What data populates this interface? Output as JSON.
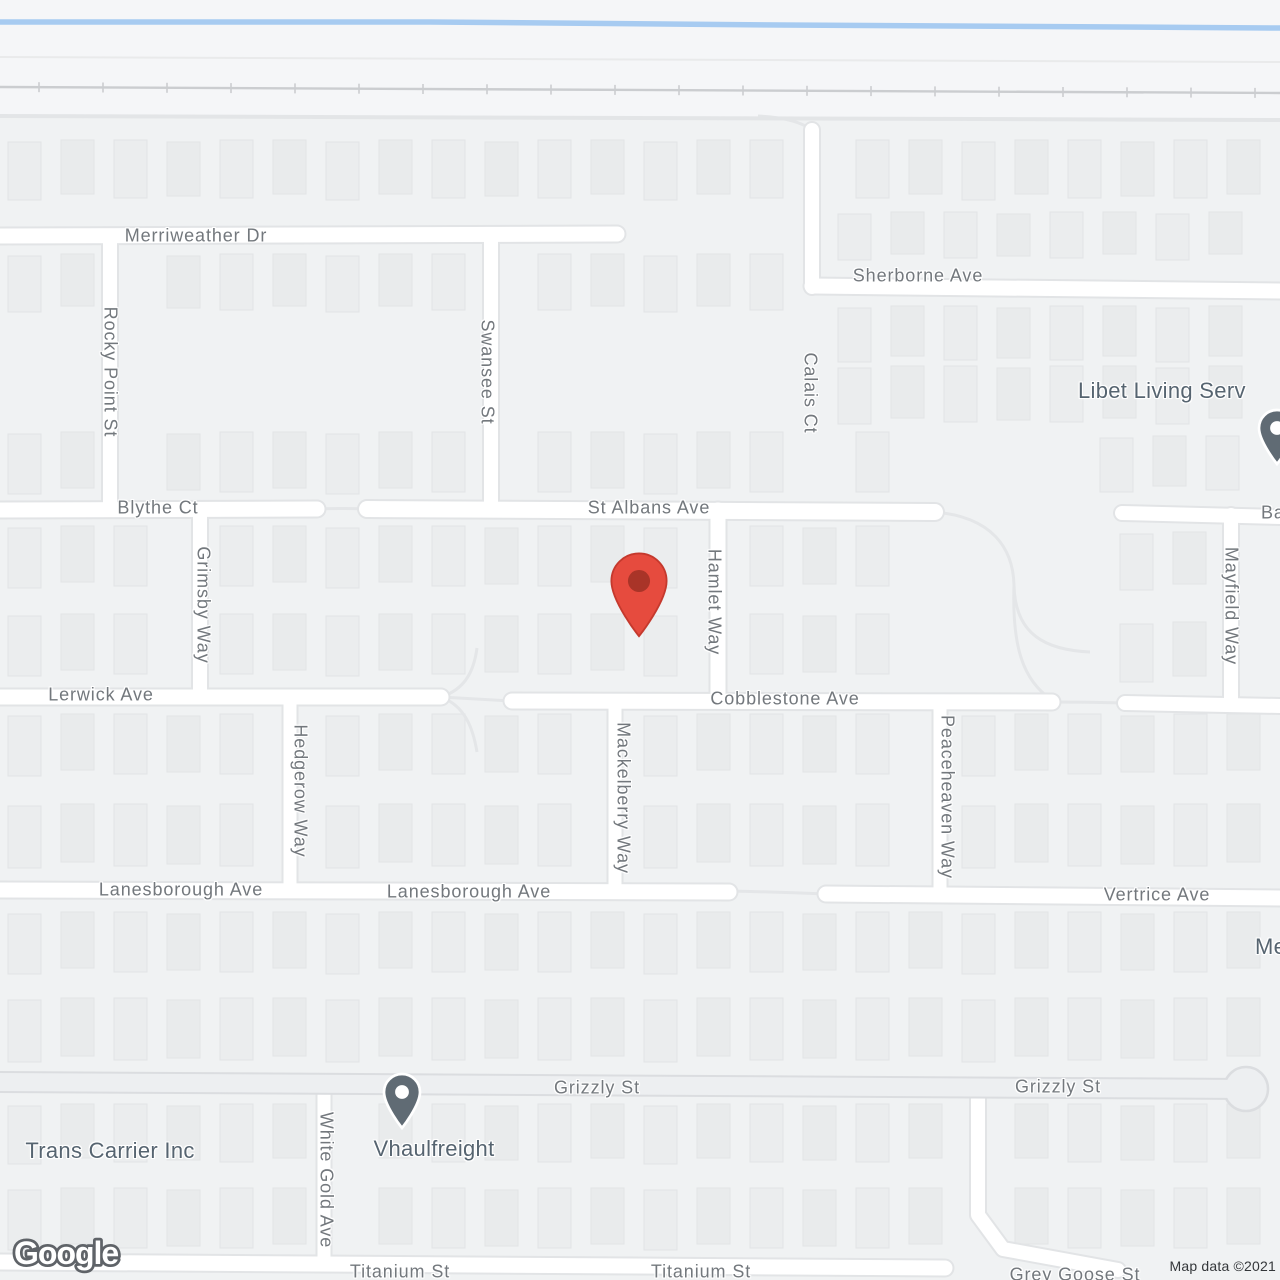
{
  "map": {
    "canvas": {
      "width": 1280,
      "height": 1280,
      "bg": "#f0f2f3",
      "upper_bg": "#f5f6f8"
    },
    "palette": {
      "road_fill": "#ffffff",
      "road_casing": "#e2e4e6",
      "major_road_fill": "#edeff1",
      "major_road_casing": "#dbdde0",
      "building_fill": "#ebedee",
      "building_fill_alt": "#e9ebec",
      "building_stroke": "#e2e4e6",
      "water": "#a7cbf1",
      "railroad": "#cbcdd0",
      "faint_line": "#e9eaeb",
      "boundary": "#e3e5e7",
      "path": "#e4e6e8"
    },
    "water_line": [
      [
        0,
        22
      ],
      [
        430,
        22
      ],
      [
        780,
        25
      ],
      [
        1280,
        28
      ]
    ],
    "faint_line": [
      [
        0,
        57
      ],
      [
        1280,
        62
      ]
    ],
    "boundary_line": [
      [
        0,
        116
      ],
      [
        1280,
        120
      ]
    ],
    "railroad": {
      "x1": 0,
      "y1": 87,
      "x2": 1280,
      "y2": 93,
      "tick_start": 39,
      "tick_step": 64,
      "tick_len": 10
    },
    "roads": [
      {
        "pts": [
          [
            0,
            236
          ],
          [
            617,
            234
          ]
        ],
        "w": 15
      },
      {
        "pts": [
          [
            812,
            286
          ],
          [
            1280,
            291
          ]
        ],
        "w": 15
      },
      {
        "pts": [
          [
            0,
            510
          ],
          [
            317,
            509
          ]
        ],
        "w": 15
      },
      {
        "pts": [
          [
            367,
            509
          ],
          [
            935,
            512
          ]
        ],
        "w": 16
      },
      {
        "pts": [
          [
            1122,
            513
          ],
          [
            1280,
            517
          ]
        ],
        "w": 14
      },
      {
        "pts": [
          [
            0,
            697
          ],
          [
            441,
            697
          ]
        ],
        "w": 15
      },
      {
        "pts": [
          [
            512,
            701
          ],
          [
            1052,
            702
          ]
        ],
        "w": 15
      },
      {
        "pts": [
          [
            1125,
            703
          ],
          [
            1280,
            706
          ]
        ],
        "w": 14
      },
      {
        "pts": [
          [
            0,
            890
          ],
          [
            729,
            892
          ]
        ],
        "w": 15
      },
      {
        "pts": [
          [
            826,
            894
          ],
          [
            1280,
            898
          ]
        ],
        "w": 15
      },
      {
        "pts": [
          [
            0,
            1262
          ],
          [
            945,
            1268
          ]
        ],
        "w": 15
      },
      {
        "pts": [
          [
            110,
            236
          ],
          [
            110,
            510
          ]
        ],
        "w": 14
      },
      {
        "pts": [
          [
            491,
            236
          ],
          [
            491,
            510
          ]
        ],
        "w": 14
      },
      {
        "pts": [
          [
            812,
            130
          ],
          [
            812,
            287
          ]
        ],
        "w": 14
      },
      {
        "pts": [
          [
            200,
            509
          ],
          [
            200,
            697
          ]
        ],
        "w": 14
      },
      {
        "pts": [
          [
            718,
            510
          ],
          [
            718,
            701
          ]
        ],
        "w": 15
      },
      {
        "pts": [
          [
            290,
            697
          ],
          [
            290,
            891
          ]
        ],
        "w": 13
      },
      {
        "pts": [
          [
            615,
            701
          ],
          [
            615,
            892
          ]
        ],
        "w": 13
      },
      {
        "pts": [
          [
            940,
            702
          ],
          [
            940,
            895
          ]
        ],
        "w": 13
      },
      {
        "pts": [
          [
            1231,
            515
          ],
          [
            1231,
            703
          ]
        ],
        "w": 14
      },
      {
        "pts": [
          [
            324,
            1090
          ],
          [
            324,
            1263
          ]
        ],
        "w": 13
      },
      {
        "pts": [
          [
            978,
            1093
          ],
          [
            978,
            1215
          ],
          [
            1003,
            1249
          ],
          [
            1118,
            1270
          ]
        ],
        "w": 14
      }
    ],
    "major_roads": [
      {
        "pts": [
          [
            0,
            1082
          ],
          [
            1246,
            1089
          ]
        ],
        "w": 18
      }
    ],
    "culdesac_bulb": {
      "x": 1246,
      "y": 1089,
      "r": 22
    },
    "paths": [
      "M317,509 Q342,508 367,509",
      "M441,697 Q476,699 512,701",
      "M441,697 C466,689 474,670 477,648",
      "M477,752 C473,728 465,706 441,697",
      "M1052,702 Q1088,702 1125,703",
      "M729,891 Q777,892 826,894",
      "M935,512 C992,517 1013,548 1014,585 C1015,635 1046,650 1090,652",
      "M1014,585 C1012,645 1022,680 1052,700",
      "M812,130 C800,121 780,117 758,116"
    ],
    "building_strips": [
      {
        "y": 140,
        "h": 58,
        "x0": 8,
        "x1": 1272,
        "skip": [
          812
        ]
      },
      {
        "y": 212,
        "h": 46,
        "x0": 838,
        "x1": 1272,
        "skip": [
          812
        ]
      },
      {
        "y": 254,
        "h": 56,
        "x0": 8,
        "x1": 796,
        "skip": [
          110,
          491
        ]
      },
      {
        "y": 306,
        "h": 54,
        "x0": 838,
        "x1": 1272,
        "skip": []
      },
      {
        "y": 366,
        "h": 56,
        "x0": 838,
        "x1": 1272,
        "skip": []
      },
      {
        "y": 432,
        "h": 60,
        "x0": 8,
        "x1": 926,
        "skip": [
          110,
          491,
          810
        ]
      },
      {
        "y": 436,
        "h": 54,
        "x0": 1100,
        "x1": 1272,
        "skip": []
      },
      {
        "y": 526,
        "h": 60,
        "x0": 8,
        "x1": 924,
        "skip": [
          200,
          718
        ]
      },
      {
        "y": 532,
        "h": 56,
        "x0": 1120,
        "x1": 1272,
        "skip": [
          1231
        ]
      },
      {
        "y": 614,
        "h": 60,
        "x0": 8,
        "x1": 924,
        "skip": [
          200,
          718
        ]
      },
      {
        "y": 622,
        "h": 58,
        "x0": 1120,
        "x1": 1272,
        "skip": [
          1231
        ]
      },
      {
        "y": 714,
        "h": 60,
        "x0": 8,
        "x1": 1272,
        "skip": [
          290,
          615,
          940
        ]
      },
      {
        "y": 804,
        "h": 62,
        "x0": 8,
        "x1": 1272,
        "skip": [
          290,
          615,
          940
        ]
      },
      {
        "y": 912,
        "h": 60,
        "x0": 8,
        "x1": 1272,
        "skip": []
      },
      {
        "y": 998,
        "h": 62,
        "x0": 8,
        "x1": 1272,
        "skip": []
      },
      {
        "y": 1104,
        "h": 58,
        "x0": 8,
        "x1": 1272,
        "skip": [
          324,
          978
        ]
      },
      {
        "y": 1188,
        "h": 60,
        "x0": 8,
        "x1": 1272,
        "skip": [
          324,
          978
        ]
      }
    ],
    "building_w": 33,
    "building_step": 53
  },
  "markers": {
    "destination_pin": {
      "x": 639,
      "y": 581,
      "scale": 2.3,
      "fill": "#e64b3e",
      "stroke": "#c5392d",
      "dot": "#a93428"
    },
    "poi_pin_style": {
      "scale": 1.5,
      "fill": "#606b74",
      "outline": "#ffffff",
      "dot": "#ffffff"
    },
    "poi_pins": [
      {
        "name": "vhaulfreight-pin",
        "x": 402,
        "y": 1092
      },
      {
        "name": "libet-living-serv-pin",
        "x": 1277,
        "y": 428
      }
    ]
  },
  "labels": {
    "merriweather": {
      "text": "Merriweather Dr",
      "x": 196,
      "y": 236
    },
    "sherborne": {
      "text": "Sherborne Ave",
      "x": 918,
      "y": 276
    },
    "blythe": {
      "text": "Blythe Ct",
      "x": 158,
      "y": 508
    },
    "stalbans": {
      "text": "St Albans Ave",
      "x": 649,
      "y": 508
    },
    "lerwick": {
      "text": "Lerwick Ave",
      "x": 101,
      "y": 695
    },
    "cobblestone": {
      "text": "Cobblestone Ave",
      "x": 785,
      "y": 699
    },
    "lanesborough_w": {
      "text": "Lanesborough Ave",
      "x": 181,
      "y": 890
    },
    "lanesborough_e": {
      "text": "Lanesborough Ave",
      "x": 469,
      "y": 892
    },
    "vertrice": {
      "text": "Vertrice Ave",
      "x": 1157,
      "y": 895
    },
    "grizzly_w": {
      "text": "Grizzly St",
      "x": 597,
      "y": 1088
    },
    "grizzly_e": {
      "text": "Grizzly St",
      "x": 1058,
      "y": 1087
    },
    "titanium_w": {
      "text": "Titanium St",
      "x": 400,
      "y": 1272
    },
    "titanium_e": {
      "text": "Titanium St",
      "x": 701,
      "y": 1272
    },
    "greygoose": {
      "text": "Grey Goose St",
      "x": 1075,
      "y": 1275
    },
    "ba": {
      "text": "Ba",
      "x": 1261,
      "y": 513,
      "anchor": "left"
    },
    "rocky": {
      "text": "Rocky Point St",
      "x": 110,
      "y": 372,
      "rot": 90
    },
    "swansee": {
      "text": "Swansee St",
      "x": 487,
      "y": 372,
      "rot": 90
    },
    "calais": {
      "text": "Calais Ct",
      "x": 810,
      "y": 393,
      "rot": 90
    },
    "hamlet": {
      "text": "Hamlet Way",
      "x": 714,
      "y": 602,
      "rot": 90
    },
    "grimsby": {
      "text": "Grimsby Way",
      "x": 203,
      "y": 605,
      "rot": 90
    },
    "mayfield": {
      "text": "Mayfield Way",
      "x": 1231,
      "y": 606,
      "rot": 90
    },
    "hedgerow": {
      "text": "Hedgerow Way",
      "x": 300,
      "y": 791,
      "rot": 90
    },
    "mackelberry": {
      "text": "Mackelberry Way",
      "x": 623,
      "y": 798,
      "rot": 90
    },
    "peaceheaven": {
      "text": "Peaceheaven Way",
      "x": 947,
      "y": 797,
      "rot": 90
    },
    "whitegold": {
      "text": "White Gold Ave",
      "x": 326,
      "y": 1180,
      "rot": 90
    },
    "libet": {
      "text": "Libet Living Serv",
      "x": 1078,
      "y": 391,
      "poi": true,
      "anchor": "left"
    },
    "trans": {
      "text": "Trans Carrier Inc",
      "x": 110,
      "y": 1151,
      "poi": true
    },
    "vhaul": {
      "text": "Vhaulfreight",
      "x": 434,
      "y": 1149,
      "poi": true
    },
    "me": {
      "text": "Me",
      "x": 1255,
      "y": 947,
      "poi": true,
      "anchor": "left"
    }
  },
  "attribution": {
    "logo": "Google",
    "map_data": "Map data ©2021"
  }
}
